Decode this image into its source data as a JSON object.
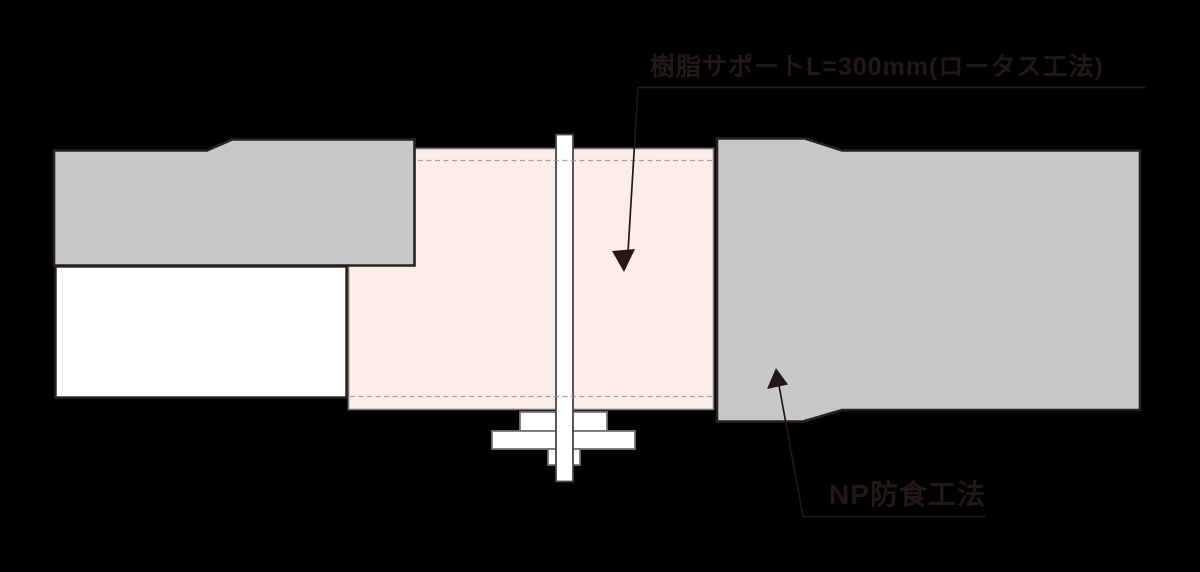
{
  "labels": {
    "resin_support": "樹脂サポートL=300mm(ロータス工法)",
    "np_coating": "NP防食工法"
  },
  "colors": {
    "background": "#000000",
    "pipe_fill": "#c8c8ca",
    "pipe_outline": "#2a211c",
    "lining_fill": "#fbeee9",
    "lining_outline": "#7d7477",
    "bore_fill": "#ffffff",
    "bore_outline": "#2a211c",
    "hardware_fill": "#ffffff",
    "hardware_outline": "#7a7475",
    "bolt_outline": "#4c4344",
    "dashed_line": "#9b918d",
    "leader_line": "#231815",
    "label_text": "#231815"
  }
}
